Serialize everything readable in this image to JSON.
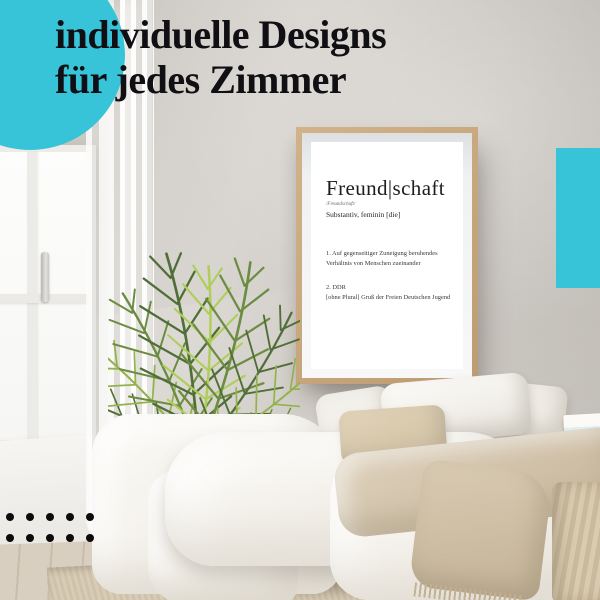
{
  "headline": {
    "line1": "individuelle Designs",
    "line2": "für jedes Zimmer"
  },
  "poster": {
    "title": "Freund|schaft",
    "phonetic": "/Freundschaft/",
    "word_type": "Substantiv, feminin [die]",
    "definition_1": "1. Auf gegenseitiger Zuneigung beruhendes Verhältnis von Menschen zueinander",
    "definition_2_label": "2. DDR",
    "definition_2_text": "[ohne Plural] Gruß der Freien Deutschen Jugend"
  },
  "decor": {
    "accent_color": "#38c4d8",
    "dot_color": "#0b0b0b",
    "dot_rows": 2,
    "dot_columns": 5
  }
}
